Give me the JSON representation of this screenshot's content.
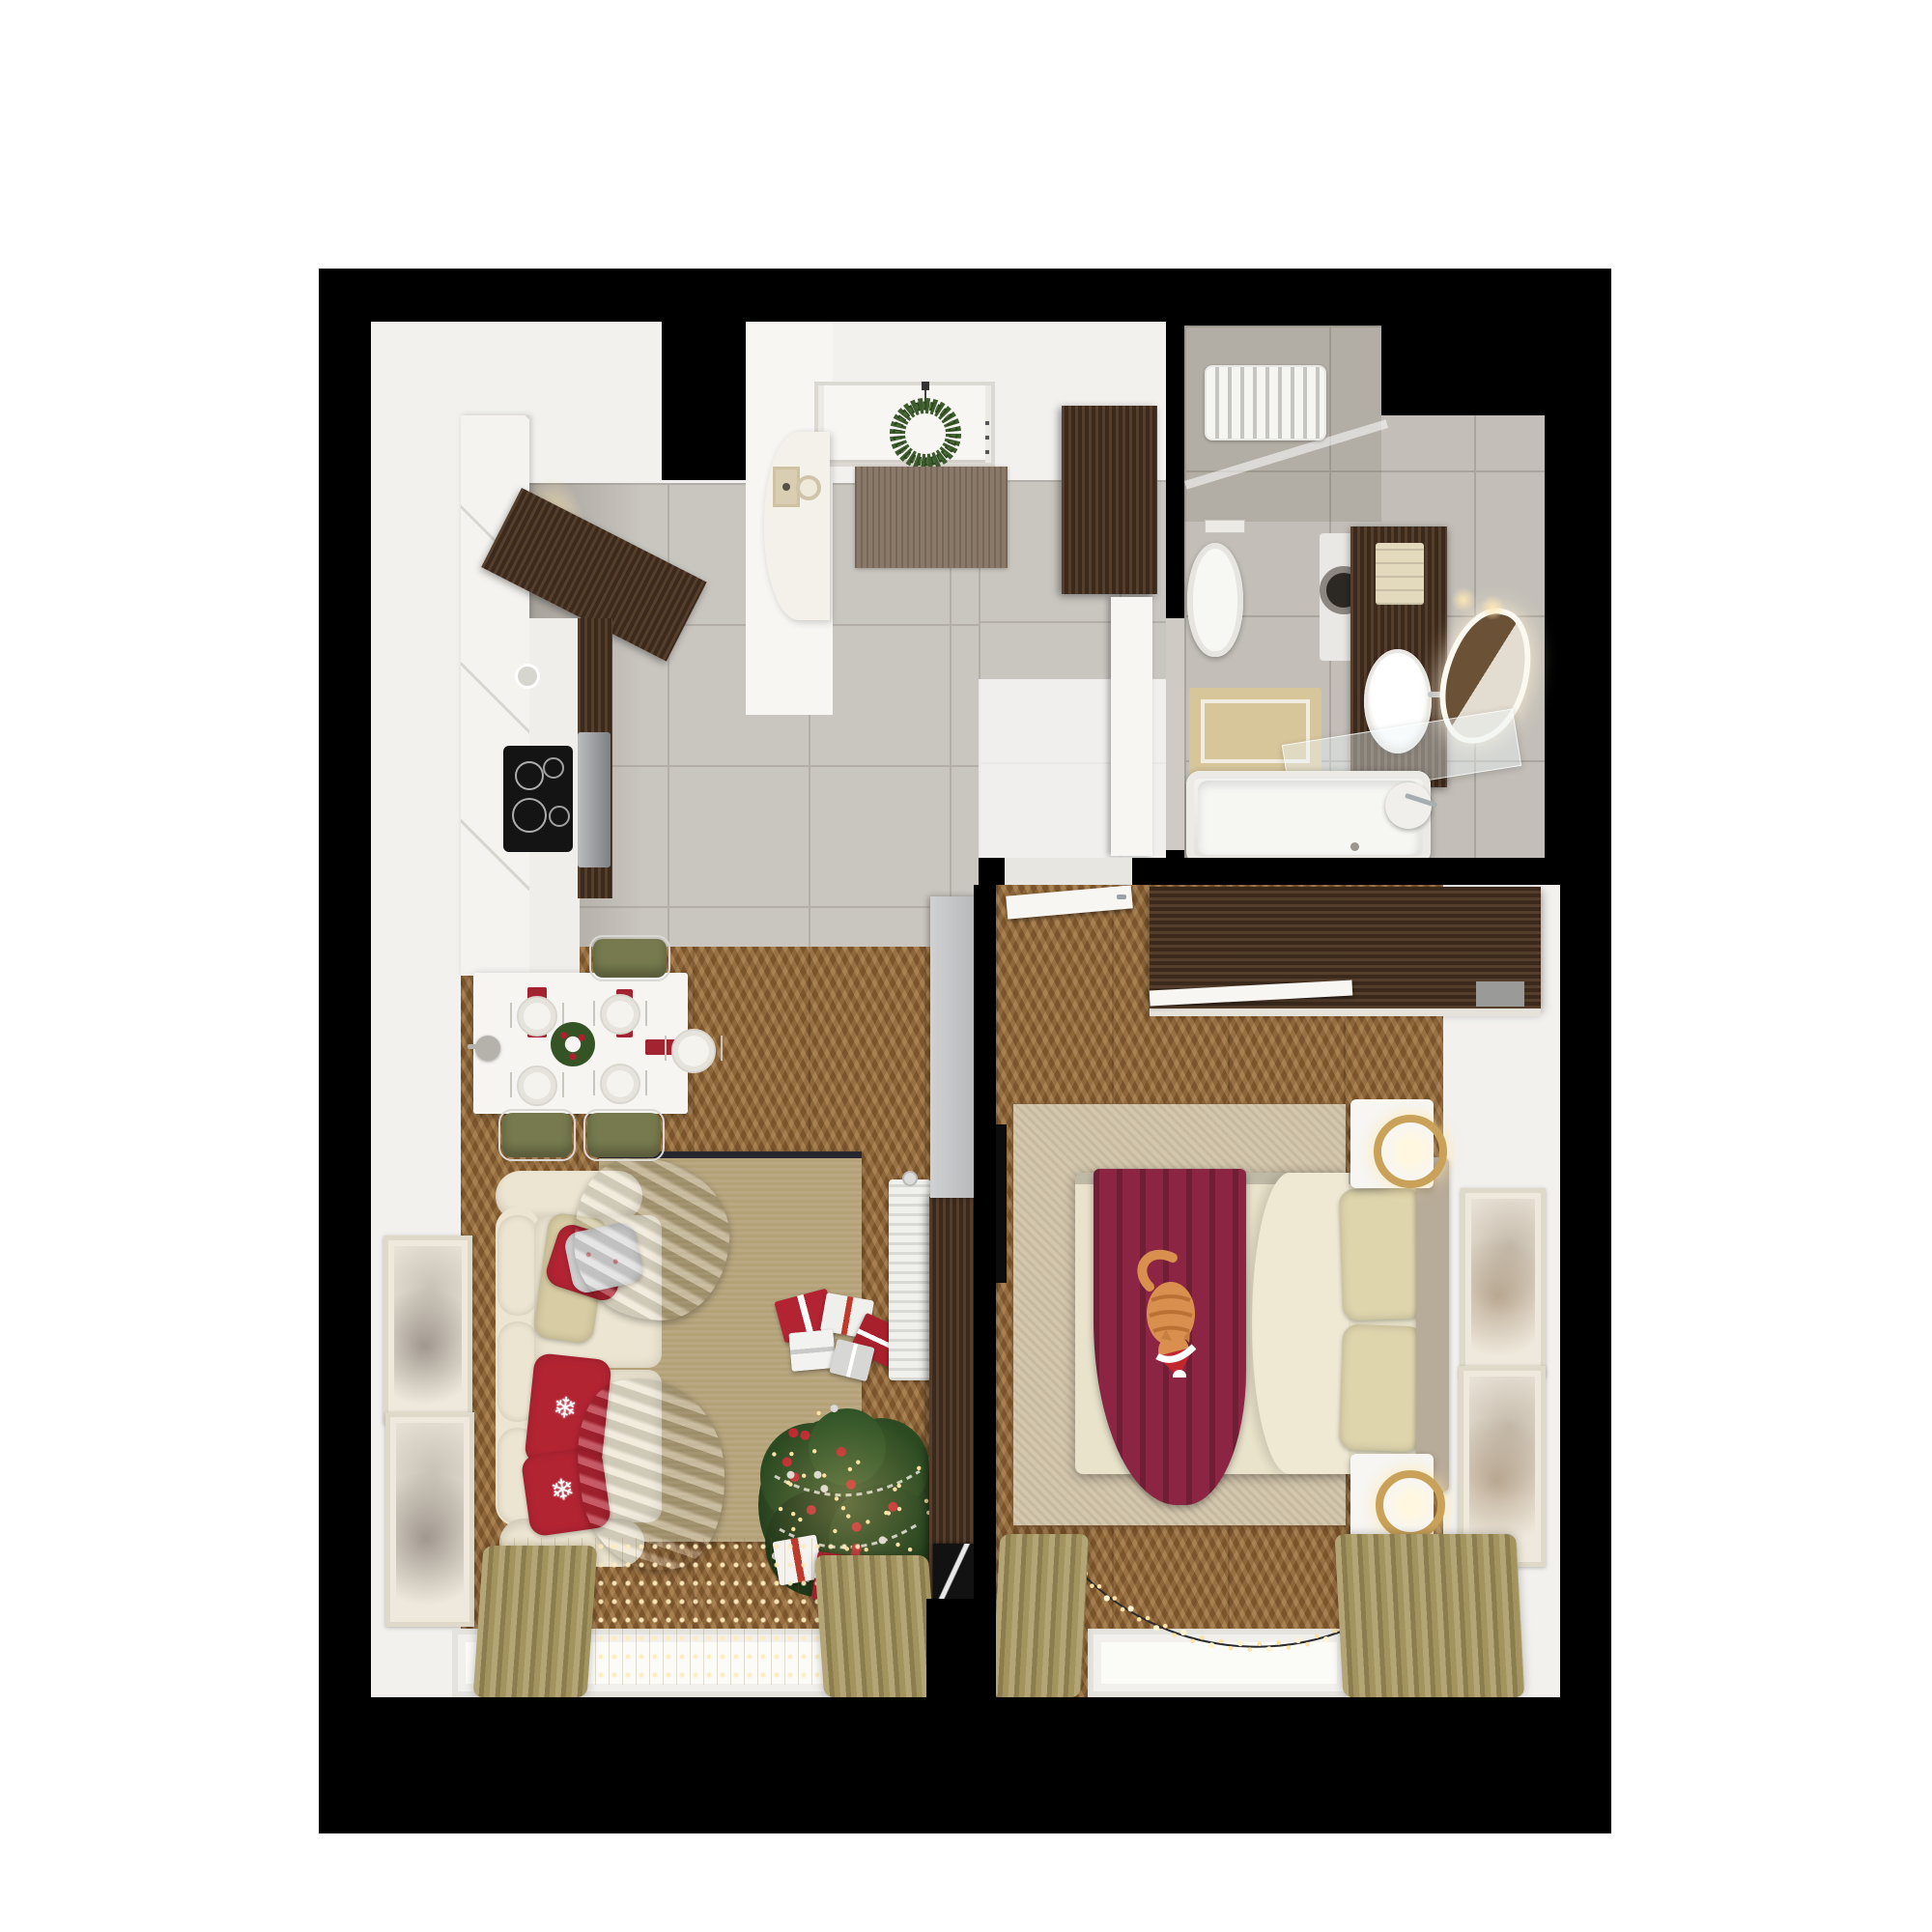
{
  "scene": {
    "type": "apartment-floor-plan-3d-top-view",
    "style": "one-bedroom apartment decorated for christmas",
    "rooms": [
      {
        "name": "kitchen",
        "floor": "gray-tile",
        "furniture": [
          "white-tall-cabinets",
          "walnut-hood-counter",
          "induction-cooktop",
          "oven",
          "round-sink",
          "fruit-bowl",
          "dining-table",
          "olive-chairs"
        ]
      },
      {
        "name": "hallway",
        "floor": "gray-tile",
        "furniture": [
          "front-door",
          "christmas-wreath",
          "entry-console",
          "doormat",
          "walnut-wardrobe"
        ]
      },
      {
        "name": "living-room",
        "floor": "chevron-wood",
        "furniture": [
          "cream-sofa",
          "red-snowflake-pillows",
          "gray-blankets",
          "christmas-tree",
          "gift-boxes",
          "area-rug",
          "radiator",
          "walnut-column",
          "poster",
          "wall-art",
          "window-curtains",
          "string-light-curtain"
        ]
      },
      {
        "name": "bedroom",
        "floor": "chevron-wood",
        "furniture": [
          "double-bed",
          "burgundy-throw",
          "cat-with-santa-hat",
          "wardrobe",
          "tv",
          "nightstands",
          "gold-ring-lamps",
          "area-rug",
          "wall-art",
          "window-curtains",
          "light-garland"
        ]
      },
      {
        "name": "bathroom",
        "floor": "gray-tile",
        "furniture": [
          "bathtub",
          "toilet",
          "washing-machine",
          "walnut-vanity",
          "basin",
          "mirror",
          "towel-radiator",
          "bath-mat",
          "glass-shelf"
        ]
      }
    ]
  },
  "palette": {
    "black": "#000000",
    "wall": "#f2f1ee",
    "tile": "#c9c5bf",
    "grout": "#b3afa8",
    "tileb": "#c3bfb8",
    "groutb": "#a9a49c",
    "wood": "#8a6134",
    "walnut": "#4a3322",
    "cream": "#ece5d1",
    "red": "#b32433",
    "burgundy": "#8c2443",
    "duvet": "#e9e3cb",
    "sheet": "#efe9d4",
    "headboard": "#b7ab99",
    "beige_pillow": "#d7cca3",
    "rug_living": "#b3a178",
    "rug_bedroom": "#d3c7ae",
    "olive": "#767a4e",
    "gold": "#c9a158",
    "lights": "#ffe3a6",
    "tree_green": "#243f1c",
    "cat": "#d98f4e",
    "gray_cabinet": "#c6c8ca"
  },
  "decor": {
    "snowflake": "❄"
  },
  "tree": {
    "lights": 46,
    "baubles_red": 12,
    "baubles_silver": 9,
    "seed": 7
  },
  "garland": {
    "spacing": 10,
    "seed": 3
  }
}
